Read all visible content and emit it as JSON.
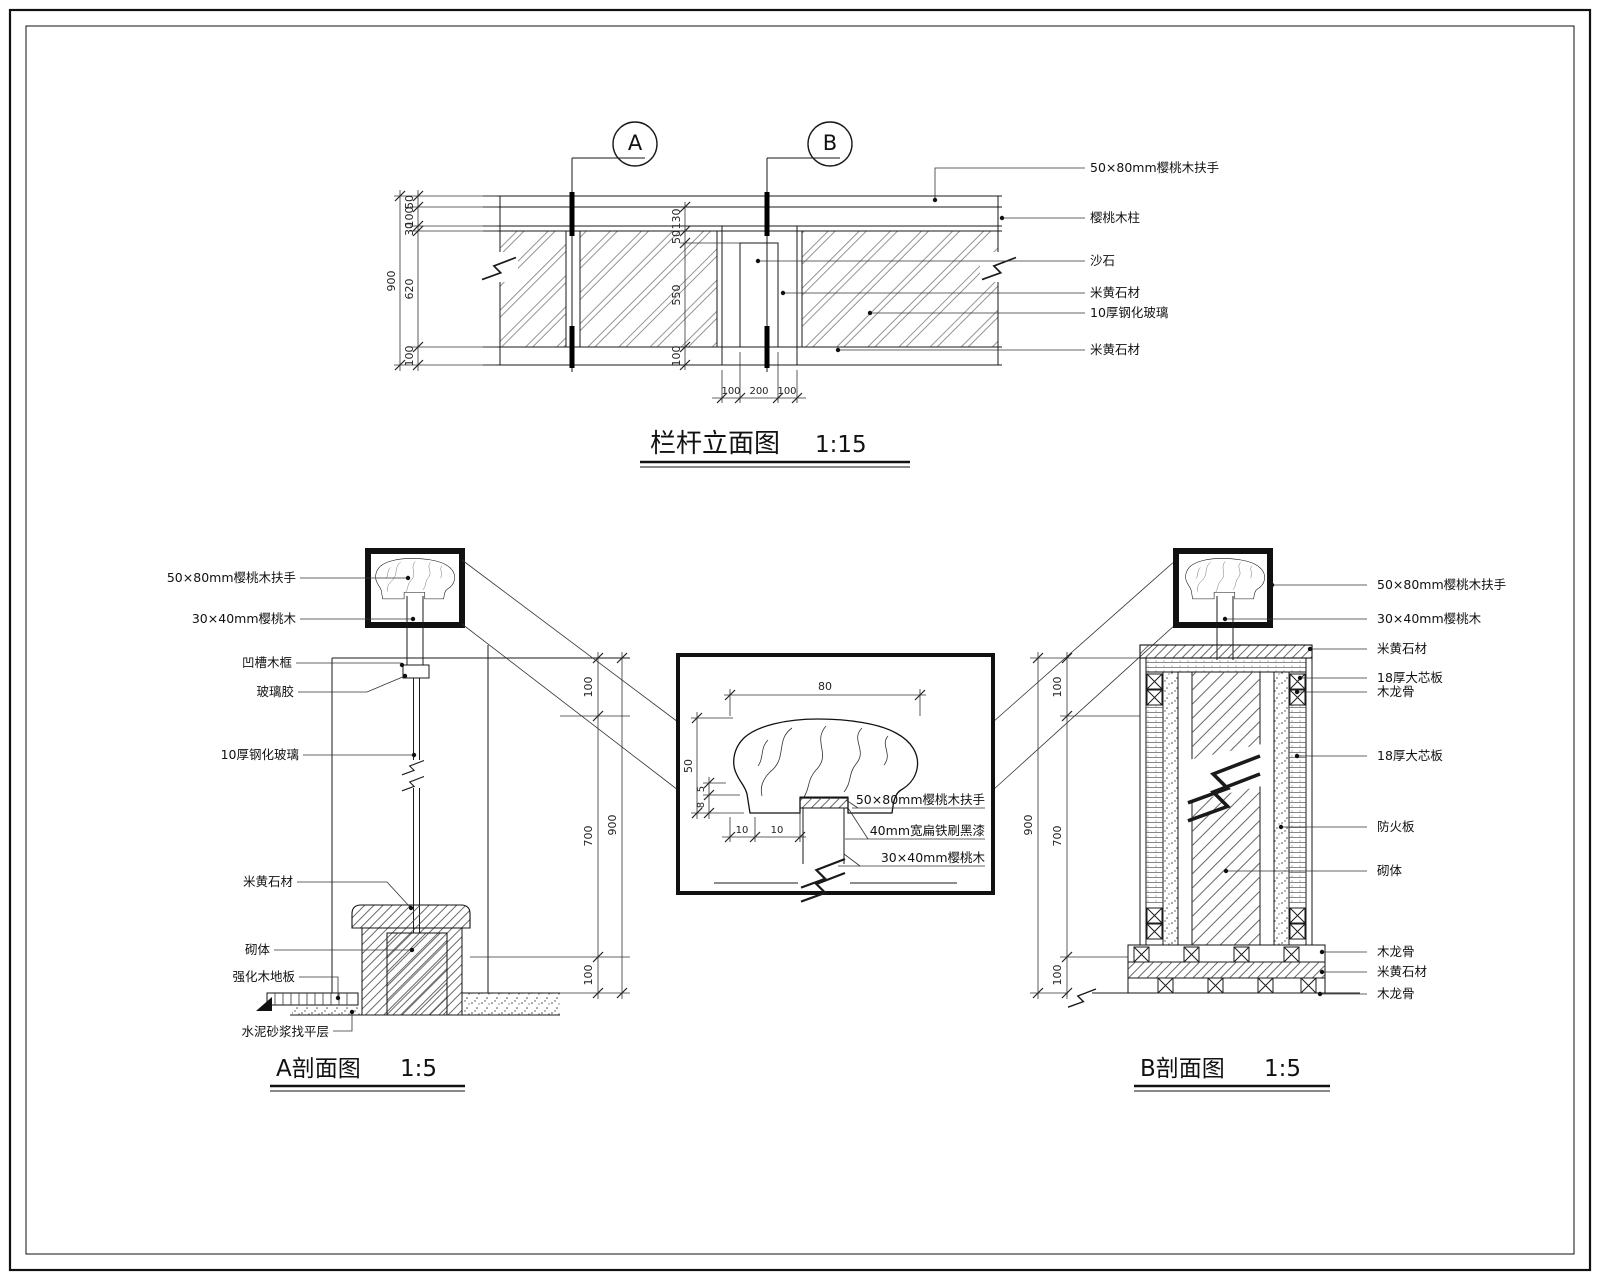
{
  "drawing": {
    "elevation": {
      "title": "栏杆立面图",
      "scale": "1:15",
      "marker_a": "A",
      "marker_b": "B",
      "labels": [
        "50×80mm樱桃木扶手",
        "樱桃木柱",
        "沙石",
        "米黄石材",
        "10厚钢化玻璃",
        "米黄石材"
      ],
      "dim_total": "900",
      "dims_left": [
        "50",
        "100",
        "30",
        "620",
        "100"
      ],
      "dims_mid": [
        "130",
        "50",
        "550",
        "100"
      ],
      "dims_bottom": [
        "100",
        "200",
        "100"
      ]
    },
    "section_a": {
      "title": "A剖面图",
      "scale": "1:5",
      "labels": [
        "50×80mm樱桃木扶手",
        "30×40mm樱桃木",
        "凹槽木框",
        "玻璃胶",
        "10厚钢化玻璃",
        "米黄石材",
        "砌体",
        "强化木地板",
        "水泥砂浆找平层"
      ],
      "dim_total": "900",
      "dims": [
        "100",
        "700",
        "100"
      ]
    },
    "detail": {
      "labels": [
        "50×80mm樱桃木扶手",
        "40mm宽扁铁刷黑漆",
        "30×40mm樱桃木"
      ],
      "dim_top": "80",
      "dims_left": [
        "50",
        "5",
        "8"
      ],
      "dims_bottom": [
        "10",
        "10"
      ]
    },
    "section_b": {
      "title": "B剖面图",
      "scale": "1:5",
      "labels": [
        "50×80mm樱桃木扶手",
        "30×40mm樱桃木",
        "米黄石材",
        "18厚大芯板",
        "木龙骨",
        "18厚大芯板",
        "防火板",
        "砌体",
        "木龙骨",
        "米黄石材",
        "木龙骨"
      ],
      "dim_total": "900",
      "dims": [
        "100",
        "700",
        "100"
      ]
    }
  }
}
